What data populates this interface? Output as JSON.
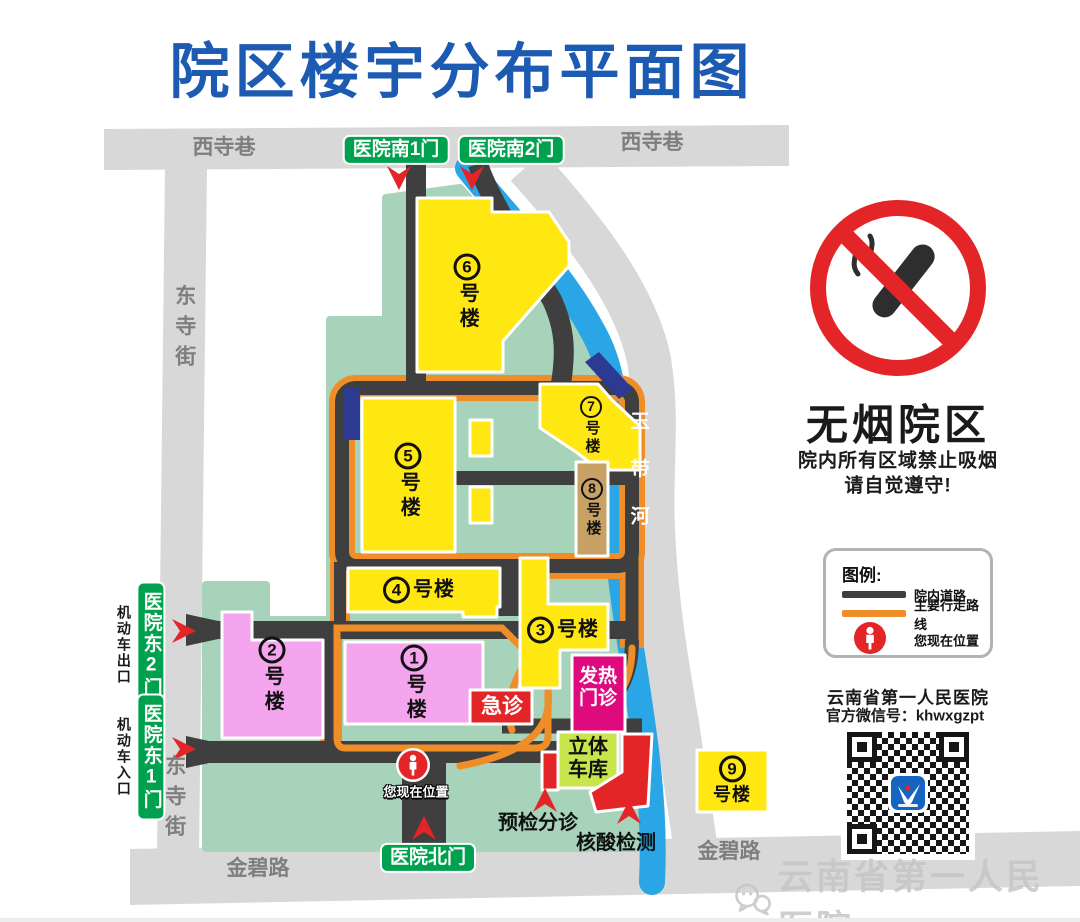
{
  "page": {
    "title": "院区楼宇分布平面图"
  },
  "streets": {
    "xisixiang_left": "西寺巷",
    "xisixiang_right": "西寺巷",
    "dongsijie_top": "东寺街",
    "dongsijie_bottom": "东寺街",
    "jinbilu_left": "金碧路",
    "jinbilu_right": "金碧路"
  },
  "river": {
    "name": "玉带河"
  },
  "gates": {
    "south1": "医院南1门",
    "south2": "医院南2门",
    "east2": "医院东2门",
    "east2_note": "机动车出口",
    "east1": "医院东1门",
    "east1_note": "机动车入口",
    "north": "医院北门"
  },
  "buildings": {
    "b1": {
      "num": "1",
      "suffix": "号楼"
    },
    "b2": {
      "num": "2",
      "suffix": "号楼"
    },
    "b3": {
      "num": "3",
      "suffix": "号楼"
    },
    "b4": {
      "num": "4",
      "suffix": "号楼"
    },
    "b5": {
      "num": "5",
      "suffix": "号楼"
    },
    "b6": {
      "num": "6",
      "suffix": "号楼"
    },
    "b7": {
      "num": "7",
      "suffix": "号楼"
    },
    "b8": {
      "num": "8",
      "suffix": "号楼"
    },
    "b9": {
      "num": "9",
      "suffix": "号楼"
    }
  },
  "facilities": {
    "emergency": "急诊",
    "fever_clinic": "发热门诊",
    "parking_garage": "立体车库",
    "triage": "预检分诊",
    "nat_test": "核酸检测",
    "you_are_here": "您现在位置"
  },
  "no_smoking": {
    "headline": "无烟院区",
    "line1": "院内所有区域禁止吸烟",
    "line2": "请自觉遵守!"
  },
  "legend": {
    "title": "图例:",
    "road": "院内道路",
    "route": "主要行走路线",
    "position": "您现在位置"
  },
  "wechat": {
    "hospital": "云南省第一人民医院",
    "account": "官方微信号：khwxgzpt"
  },
  "watermark": {
    "hospital": "云南省第一人民医院"
  },
  "colors": {
    "title_blue": "#1d5ab2",
    "gate_green": "#00a14e",
    "campus_green": "#a6d3ba",
    "building_yellow": "#ffe712",
    "building_pink": "#f5a4ee",
    "building_tan": "#c8a165",
    "fever_magenta": "#df0b7e",
    "garage_lime": "#c8e54b",
    "alert_red": "#e42528",
    "route_orange": "#ef8e28",
    "road_dark": "#3f3f3f",
    "street_gray": "#d8d8d8",
    "river_blue": "#2aa5e5",
    "navy": "#2c3a92"
  }
}
